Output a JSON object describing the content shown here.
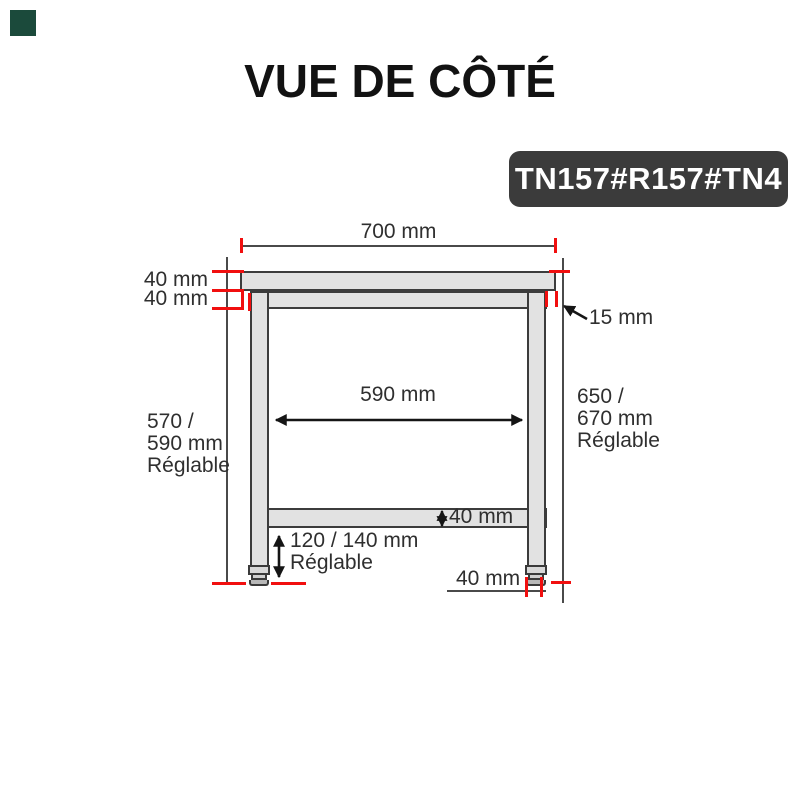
{
  "logo": {
    "color": "#1b4a3b"
  },
  "title": "VUE DE CÔTÉ",
  "badge": {
    "text": "TN157#R157#TN4",
    "bg": "#3b3b3b"
  },
  "diagram": {
    "labels": {
      "top_width": "700 mm",
      "top_thickness": "40 mm",
      "frame_thickness": "40 mm",
      "edge_offset": "15 mm",
      "inner_width": "590 mm",
      "left_height_l1": "570 /",
      "left_height_l2": "590 mm",
      "left_height_l3": "Réglable",
      "right_height_l1": "650 /",
      "right_height_l2": "670 mm",
      "right_height_l3": "Réglable",
      "shelf_thickness": "40 mm",
      "foot_height_l1": "120 / 140 mm",
      "foot_height_l2": "Réglable",
      "leg_width": "40 mm"
    },
    "colors": {
      "tick_red": "#f10f0f",
      "outline_gray": "#3c3c3c",
      "fill_gray": "#e2e2e2",
      "line_gray": "#4a4a4a"
    }
  }
}
